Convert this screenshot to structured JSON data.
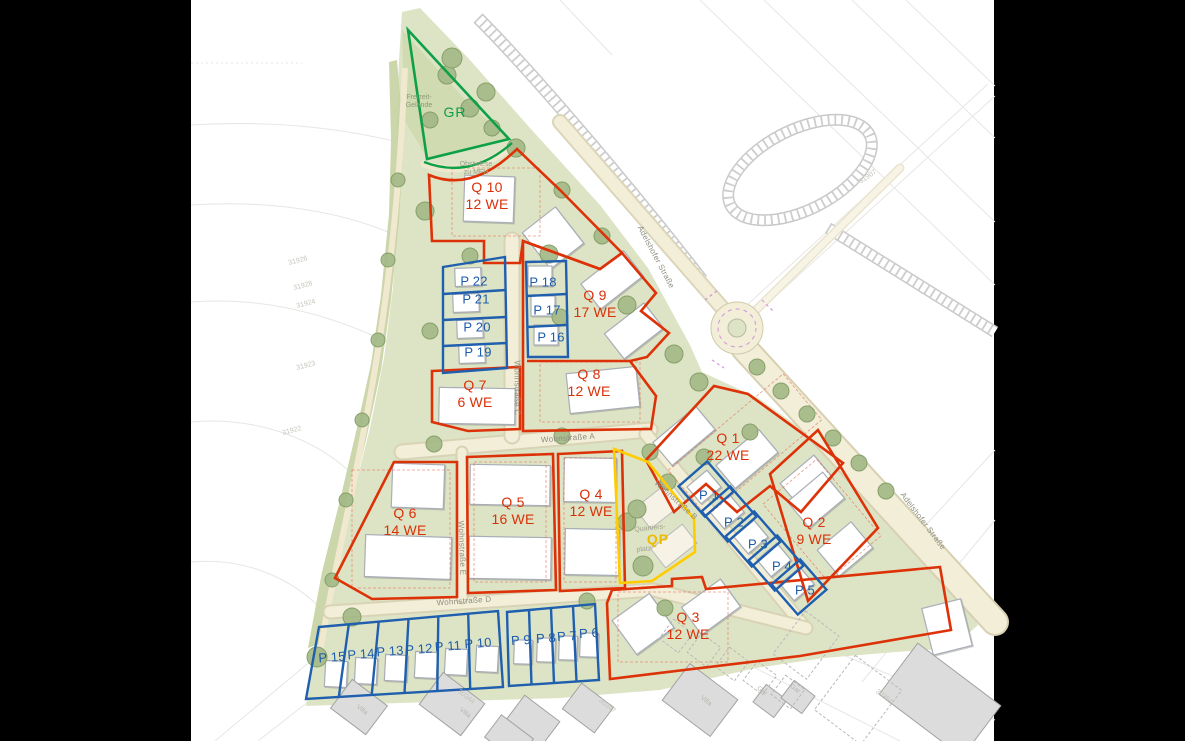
{
  "quarters": [
    {
      "label": "Q 1",
      "units": "22 WE"
    },
    {
      "label": "Q 2",
      "units": "9 WE"
    },
    {
      "label": "Q 3",
      "units": "12 WE"
    },
    {
      "label": "Q 4",
      "units": "12 WE"
    },
    {
      "label": "Q 5",
      "units": "16 WE"
    },
    {
      "label": "Q 6",
      "units": "14 WE"
    },
    {
      "label": "Q 7",
      "units": "6 WE"
    },
    {
      "label": "Q 8",
      "units": "12 WE"
    },
    {
      "label": "Q 9",
      "units": "17 WE"
    },
    {
      "label": "Q 10",
      "units": "12 WE"
    }
  ],
  "plots": [
    {
      "label": "P 1"
    },
    {
      "label": "P 2"
    },
    {
      "label": "P 3"
    },
    {
      "label": "P 4"
    },
    {
      "label": "P 5"
    },
    {
      "label": "P 6"
    },
    {
      "label": "P 7"
    },
    {
      "label": "P 8"
    },
    {
      "label": "P 9"
    },
    {
      "label": "P 10"
    },
    {
      "label": "P 11"
    },
    {
      "label": "P 12"
    },
    {
      "label": "P 13"
    },
    {
      "label": "P 14"
    },
    {
      "label": "P 15"
    },
    {
      "label": "P 16"
    },
    {
      "label": "P 17"
    },
    {
      "label": "P 18"
    },
    {
      "label": "P 19"
    },
    {
      "label": "P 20"
    },
    {
      "label": "P 21"
    },
    {
      "label": "P 22"
    }
  ],
  "special": {
    "green_area": "GR",
    "quarter_square": "QP"
  },
  "streets": {
    "a": "Wohnstraße A",
    "b": "Wohnstraße B",
    "c": "Wohnstraße C",
    "d": "Wohnstraße D",
    "e": "Wohnstraße E",
    "adelshofer": "Adelshofer Straße"
  },
  "notes": {
    "orchard_1": "Obstwiese",
    "orchard_2": "zu MFH",
    "leisure_1": "Freizeit-",
    "leisure_2": "Gelände",
    "square_1": "Quartiers-",
    "square_2": "platz"
  },
  "parcel_numbers": [
    "31926",
    "31928",
    "31924",
    "31923",
    "31922",
    "31907",
    "30344",
    "30347",
    "30351"
  ],
  "existing_labels": [
    "Villa",
    "Villa",
    "Villa",
    "Gar",
    "Gar"
  ],
  "colors": {
    "quarter_outline": "#dd3107",
    "plot_outline": "#1f5fae",
    "green_area_outline": "#0da047",
    "square_outline": "#ffcc00",
    "site_green": "#dde4c5",
    "road_beige": "#f2eed8"
  }
}
